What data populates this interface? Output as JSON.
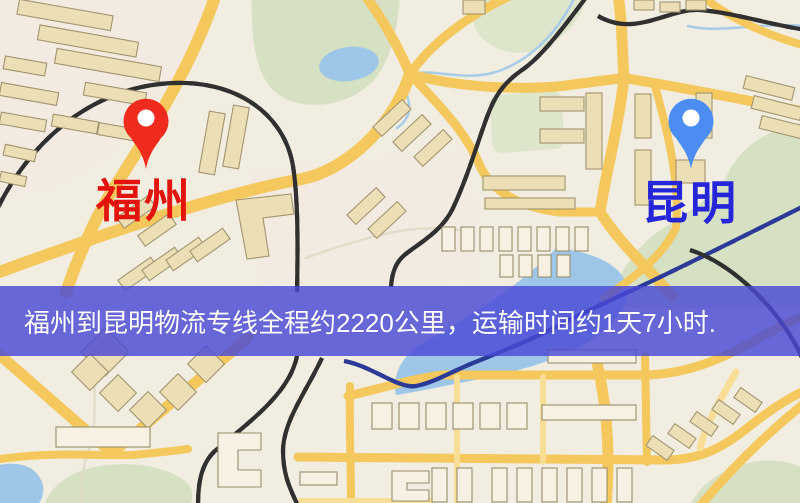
{
  "banner": {
    "text": "福州到昆明物流专线全程约2220公里，运输时间约1天7小时.",
    "background_color": "#4949d5",
    "text_color": "#ffffff"
  },
  "origin": {
    "label": "福州",
    "label_color": "#e3140e",
    "pin_color": "#ee2b1c"
  },
  "destination": {
    "label": "昆明",
    "label_color": "#2525d9",
    "pin_color": "#4b8df2"
  }
}
